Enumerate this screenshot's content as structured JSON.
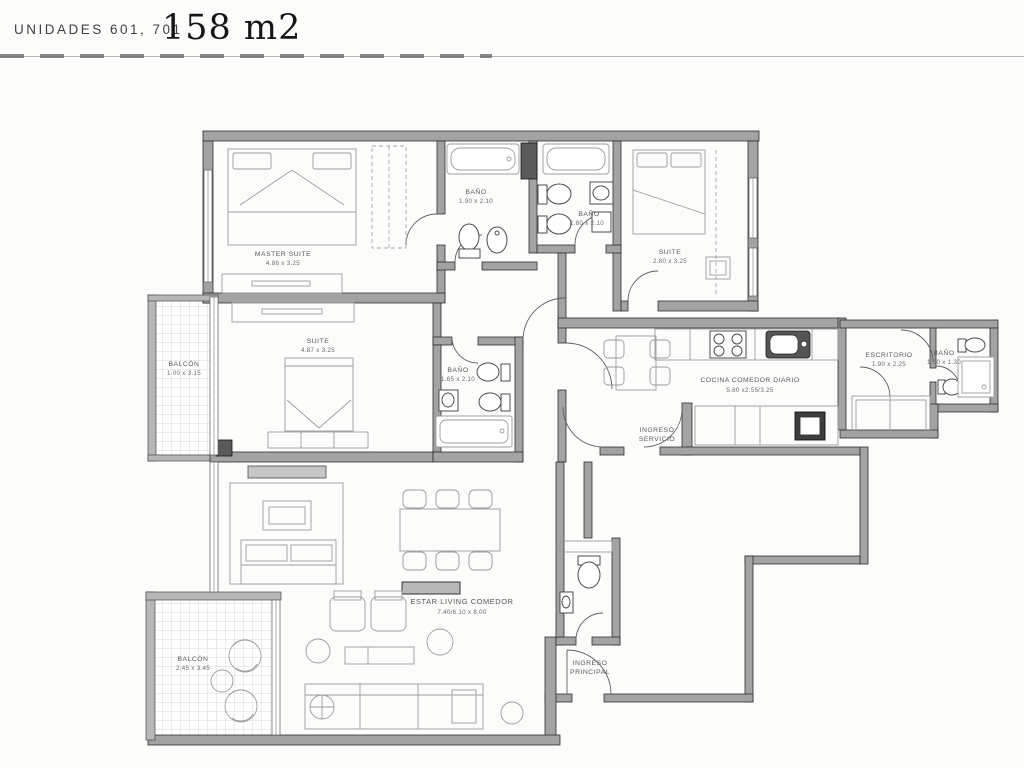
{
  "header": {
    "units_label": "UNIDADES 601, 701",
    "area_label": "158 m2"
  },
  "rooms": {
    "master_suite": {
      "name": "MASTER SUITE",
      "dims": "4.86 x 3.25"
    },
    "bano_master": {
      "name": "BAÑO",
      "dims": "1.90 x 2.10"
    },
    "bano_2": {
      "name": "BAÑO",
      "dims": "1.80 x 2.10"
    },
    "suite_2": {
      "name": "SUITE",
      "dims": "2.80 x 3.25"
    },
    "balcon_1": {
      "name": "BALCÓN",
      "dims": "1.00 x 3.15"
    },
    "suite_1": {
      "name": "SUITE",
      "dims": "4.87 x 3.25"
    },
    "bano_3": {
      "name": "BAÑO",
      "dims": "1.65 x 2.10"
    },
    "cocina": {
      "name": "COCINA COMEDOR DIARIO",
      "dims": "5.80 x2.55/3.25"
    },
    "ingreso_servicio": {
      "line1": "INGRESO",
      "line2": "SERVICIO"
    },
    "escritorio": {
      "name": "ESCRITORIO",
      "dims": "1.90 x 2.25"
    },
    "bano_servicio": {
      "name": "BAÑO",
      "dims": "1.50 x 1.30"
    },
    "estar": {
      "name": "ESTAR LIVING COMEDOR",
      "dims": "7.40/6.10 x 8.00"
    },
    "balcon_2": {
      "name": "BALCÓN",
      "dims": "2.45 x 3.45"
    },
    "ingreso_principal": {
      "line1": "INGRESO",
      "line2": "PRINCIPAL"
    }
  }
}
